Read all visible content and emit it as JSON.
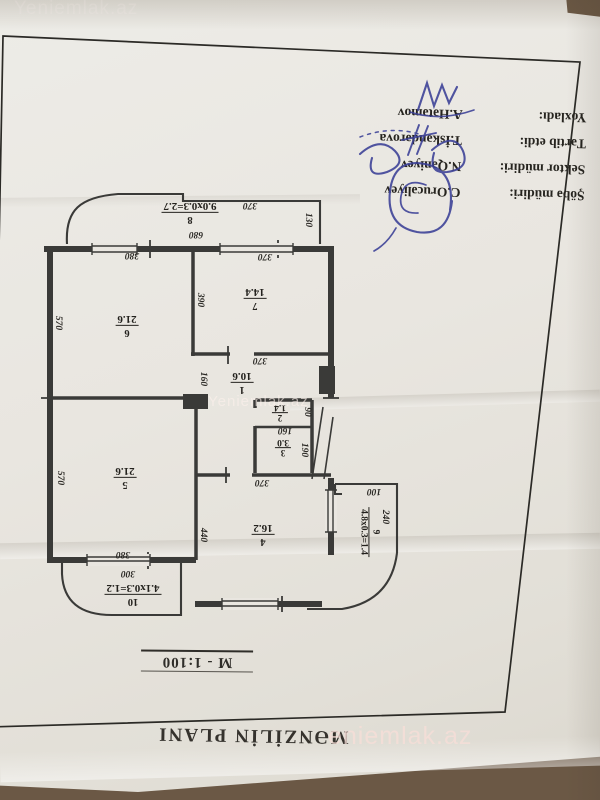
{
  "page": {
    "title": "MƏNZİLİN PLANI",
    "scale": "M - 1:100"
  },
  "stamp": {
    "rows": [
      {
        "label": "Şöbə müdiri:",
        "value": "C.Orucəliyev"
      },
      {
        "label": "Sektor müdiri:",
        "value": "N.Qəniyev"
      },
      {
        "label": "Tərtib etdi:",
        "value": "T.İskəndərova"
      },
      {
        "label": "Yoxladı:",
        "value": "A.Hətəmov"
      }
    ]
  },
  "plan": {
    "rooms": {
      "r1": {
        "num": "1",
        "area": "10.6"
      },
      "r2": {
        "num": "2",
        "area": "1.4"
      },
      "r3": {
        "num": "3",
        "area": "3.0"
      },
      "r4": {
        "num": "4",
        "area": "16.2"
      },
      "r5": {
        "num": "5",
        "area": "21.6"
      },
      "r6": {
        "num": "6",
        "area": "21.6"
      },
      "r7": {
        "num": "7",
        "area": "14.4"
      },
      "r8": {
        "num": "8",
        "area": "9.0x0.3=2.7"
      },
      "r9": {
        "num": "9",
        "area": "4.8x0.3=1.4"
      },
      "r10": {
        "num": "10",
        "area": "4.1x0.3=1.2"
      }
    },
    "dims": [
      "380",
      "370",
      "680",
      "370",
      "130",
      "570",
      "390",
      "370",
      "160",
      "370",
      "440",
      "90",
      "160",
      "190",
      "570",
      "380",
      "300",
      "100",
      "240"
    ]
  },
  "watermark": {
    "center": "Yeniemlak.az",
    "bottom": "eniemlak.az",
    "top": "Yeniemlak.az"
  },
  "colors": {
    "paper": "#e9e6e0",
    "ink": "#3a3a38",
    "signature": "#3a3f96",
    "background": "#6b5845",
    "watermark": "#f8ded8"
  }
}
